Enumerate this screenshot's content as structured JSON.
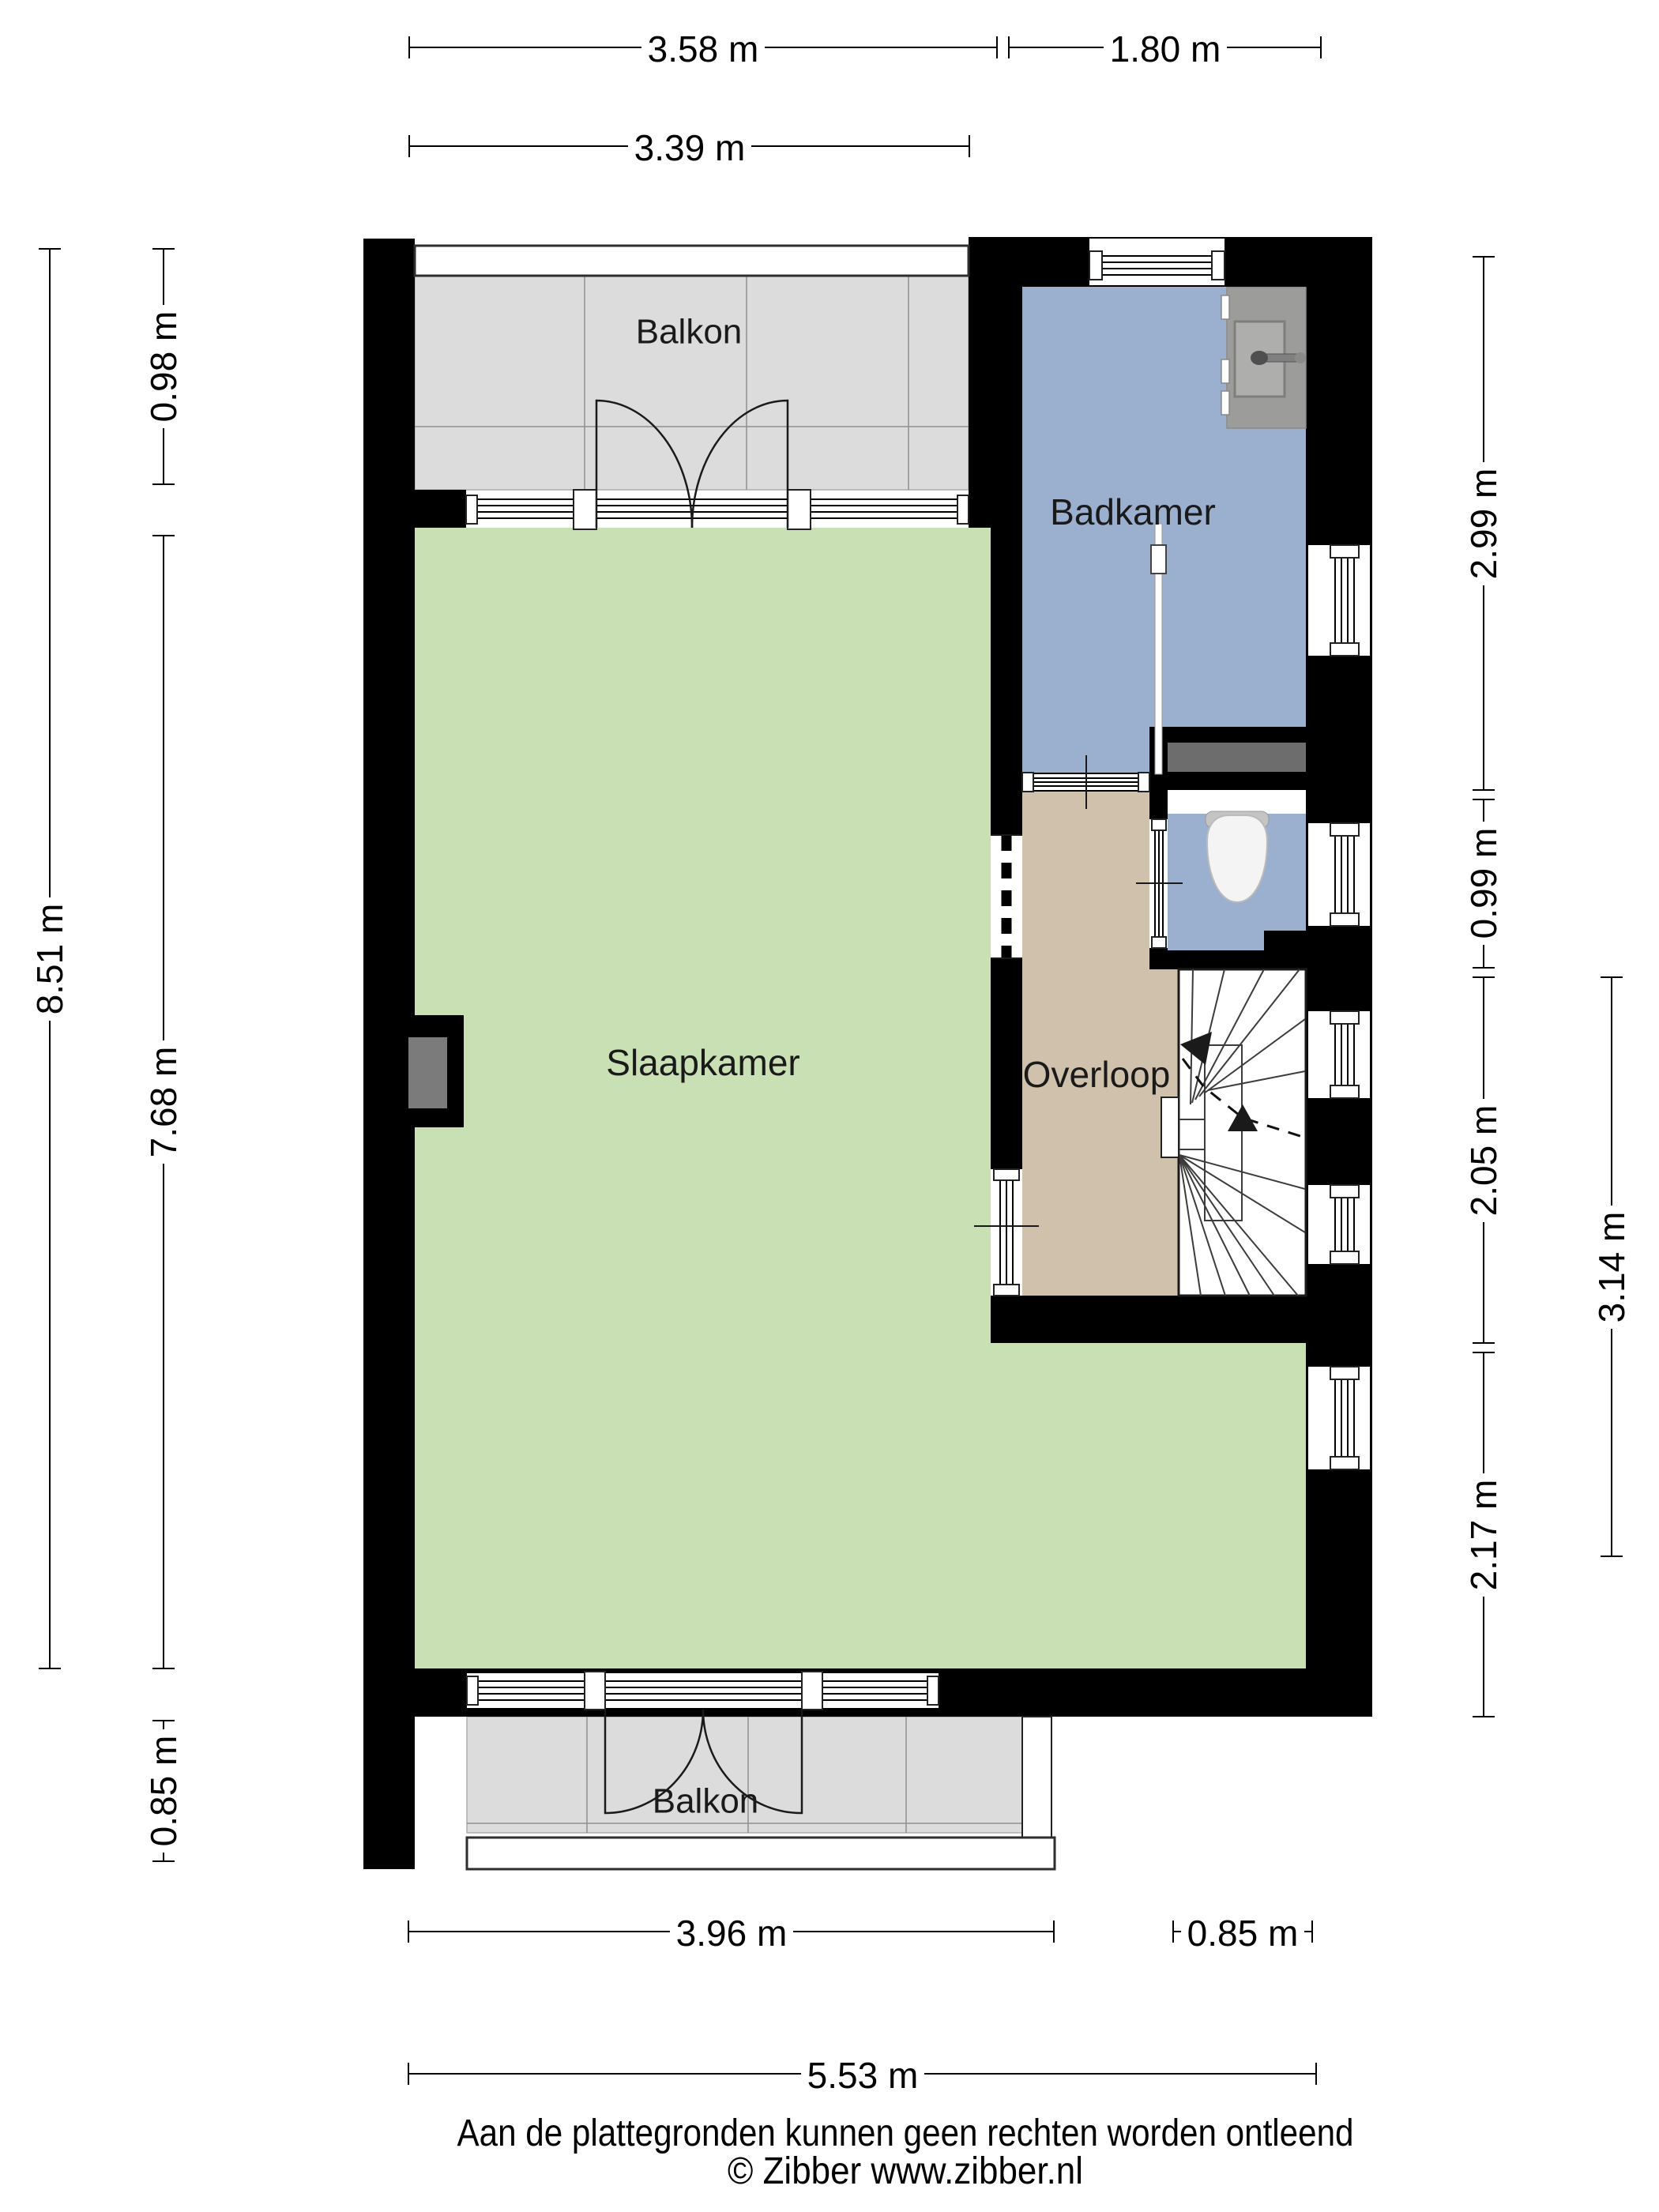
{
  "title": "Floor plan (plattegrond) - verdieping",
  "rooms": {
    "balkon_top": {
      "label": "Balkon"
    },
    "badkamer": {
      "label": "Badkamer"
    },
    "slaapkamer": {
      "label": "Slaapkamer"
    },
    "overloop": {
      "label": "Overloop"
    },
    "balkon_bottom": {
      "label": "Balkon"
    }
  },
  "dimensions": {
    "top_row1_left": "3.58 m",
    "top_row1_right": "1.80 m",
    "top_row2": "3.39 m",
    "left_outer": "8.51 m",
    "left_inner_top": "0.98 m",
    "left_inner_main": "7.68 m",
    "left_inner_bottom": "0.85 m",
    "right_inner_1": "2.99 m",
    "right_inner_2": "0.99 m",
    "right_inner_3": "2.05 m",
    "right_inner_4": "2.17 m",
    "right_outer": "3.14 m",
    "bottom_row1_left": "3.96 m",
    "bottom_row1_right": "0.85 m",
    "bottom_row2": "5.53 m"
  },
  "footer": {
    "disclaimer": "Aan de plattegronden kunnen geen rechten worden ontleend",
    "copyright": "© Zibber www.zibber.nl"
  },
  "colors": {
    "wall": "#000000",
    "bedroom_green": "#c9dfb4",
    "bathroom_blue": "#9bafce",
    "landing_tan": "#cfc1ab",
    "balcony_grey": "#dcdcdc",
    "vanity_grey": "#9c9c9a",
    "basin_grey": "#aeaeac",
    "cistern_grey": "#6d6d6d",
    "duct_grey": "#7b7b7b",
    "toilet_white": "#f4f4f4"
  }
}
